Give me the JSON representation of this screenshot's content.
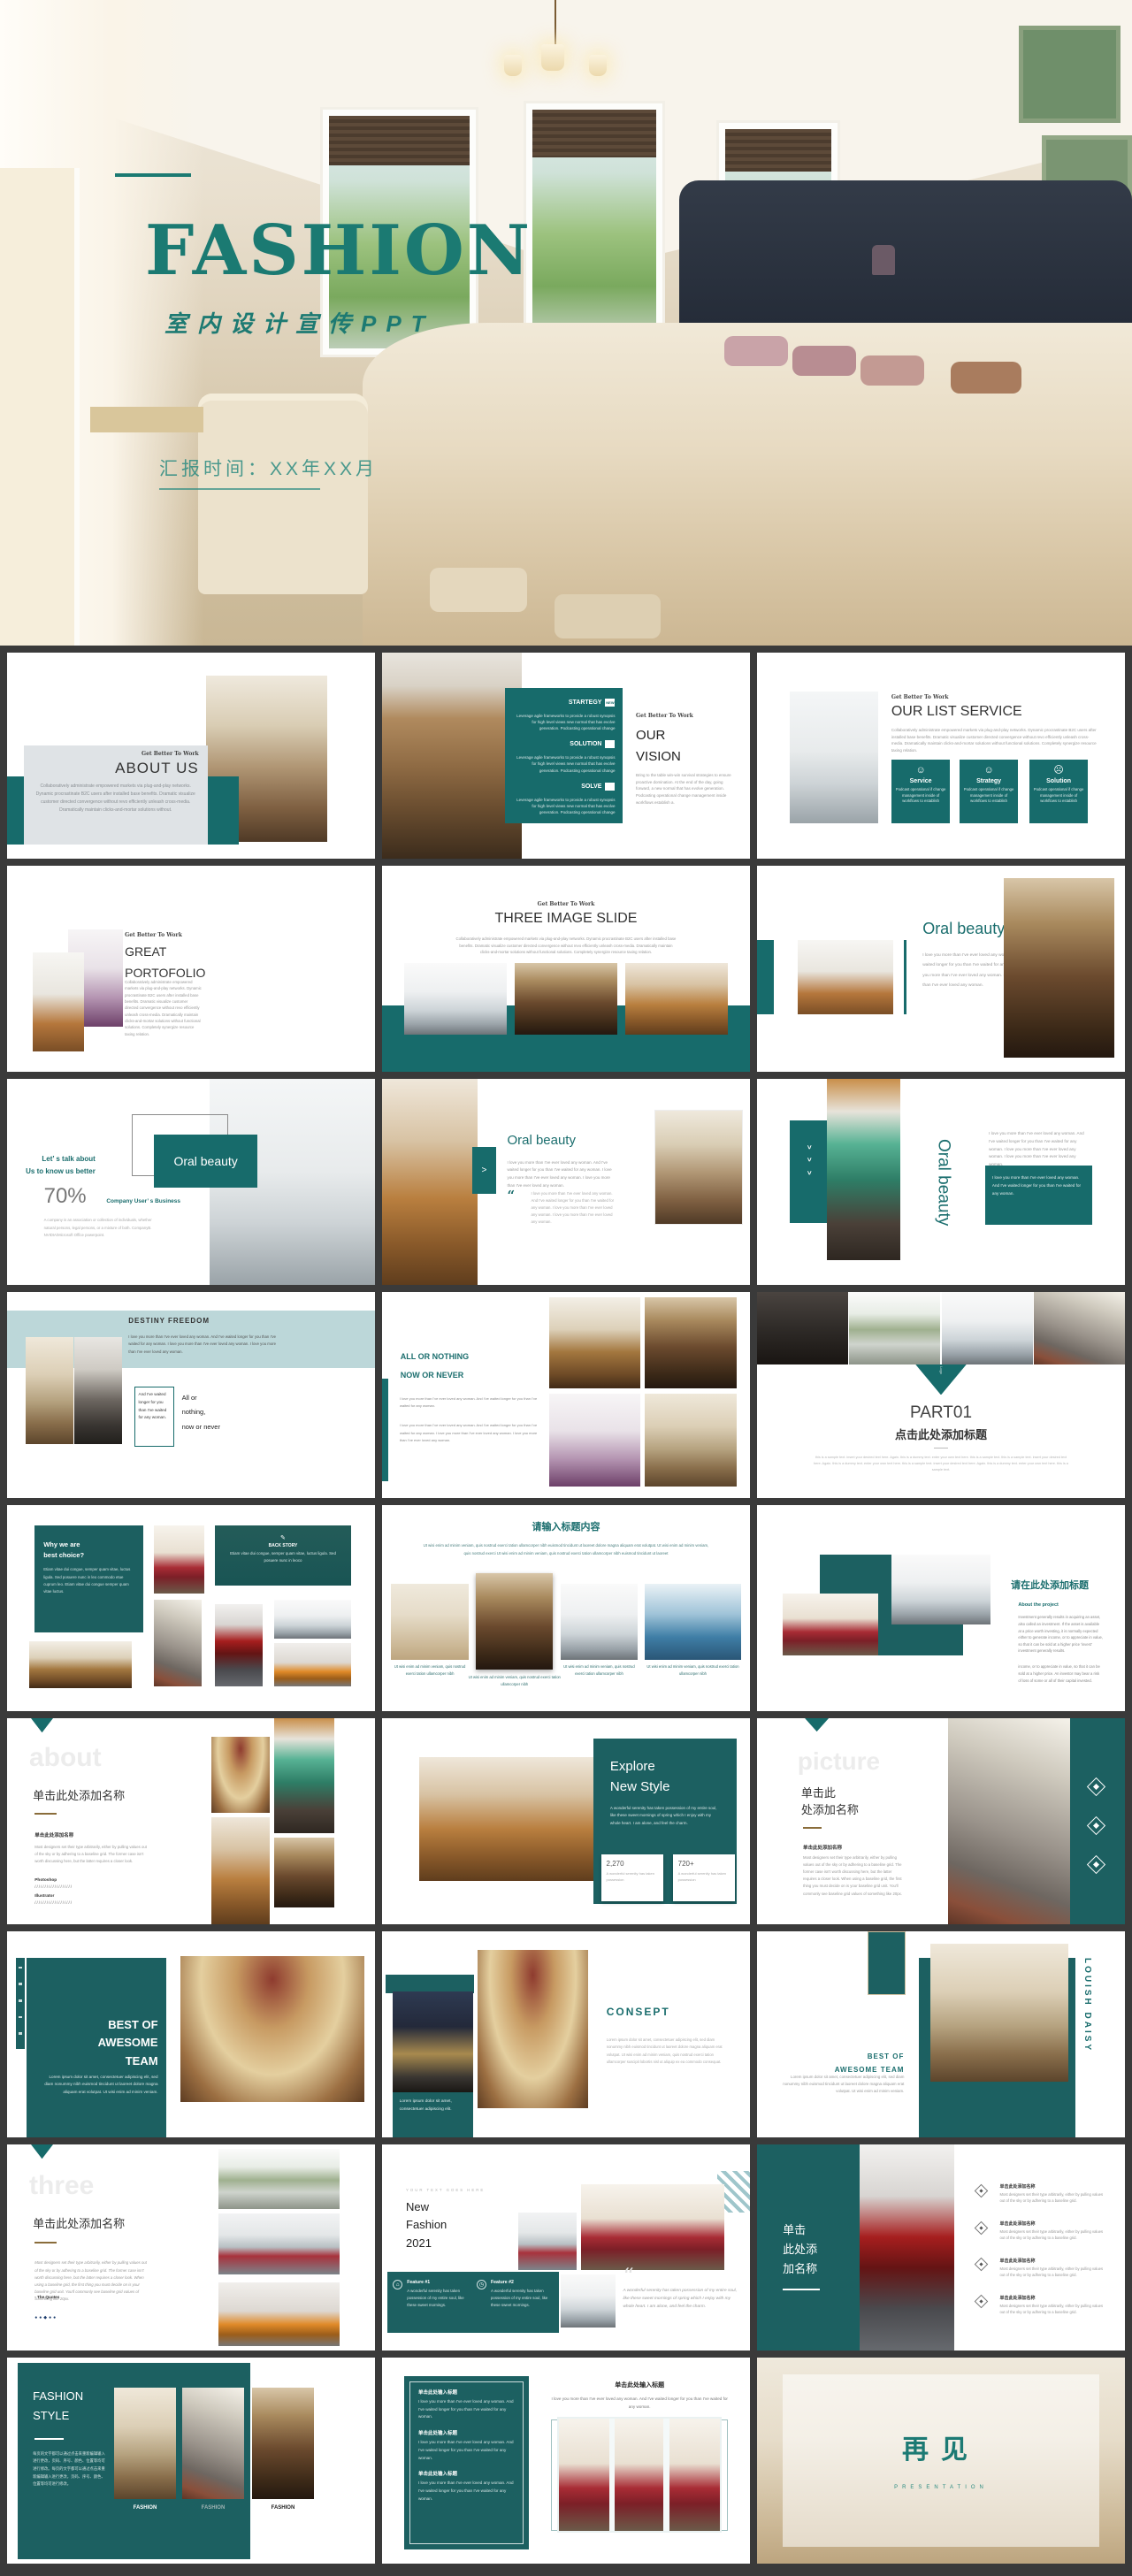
{
  "page": {
    "background": "#3a3a3a",
    "accent": "#176b6b"
  },
  "hero": {
    "title": "FASHION",
    "subtitle": "室内设计宣传PPT",
    "report_time": "汇报时间：XX年XX月"
  },
  "shared": {
    "kicker": "Get Better To Work",
    "collab_short": "Collaboratively administrate empowered markets via plug-and-play networks. Dynamic procrastinate B2C users after installed base benefits. Dramatic visualize customer directed convergence without revo efficiently unleash cross-media. Dramatically maintain clicks-and-mortar solutions without.",
    "collab": "Collaboratively administrate empowered markets via plug-and-play networks. Dynamic procrastinate B2C users after installed base benefits. Dramatic visualize customer directed convergence without revo efficiently unleash cross-media. Dramatically maintain clicks-and-mortar solutions without functional solutions. Completely synergize resource taxing relation.",
    "leverage": "Leverage agile frameworks to provide a robust synopsis for high level views new normal that has evolve generation. Podcasting operational change",
    "podcast": "Podcast operational if change management inside of workflows to establish",
    "love": "I love you more than I've ever loved any woman. And I've waited longer for you than I've waited for any woman.",
    "love_long": "I love you more than I've ever loved any woman. And I've waited longer for you than I've waited for any woman. I love you more than I've ever loved any woman. I love you more than I've ever loved any woman.",
    "designers": "Most designers set their type arbitrarily, either by pulling values out of the sky or by adhering to a baseline grid. The former case isn't worth discussing here, but the latter requires a closer look.",
    "designers_long": "Most designers set their type arbitrarily, either by pulling values out of the sky or by adhering to a baseline grid. The former case isn't worth discussing here, but the latter requires a closer look. When using a baseline grid, the first thing you must decide on is your baseline grid unit. You'll commonly see baseline grid values of something like 20px.",
    "designers_tiny": "Most designers set their type arbitrarily, either by pulling values out of the sky or by adhering to a baseline grid.",
    "lorem": "Lorem ipsum dolor sit amet, consectetuer adipiscing elit, sed diam nonummy nibh euismod tincidunt ut laoreet dolore magna aliquam erat volutpat. Ut wisi enim ad minim veniam.",
    "lorem_long": "Lorem ipsum dolor sit amet, consectetuer adipiscing elit, sed diam nonummy nibh euismod tincidunt ut laoreet dolore magna aliquam erat volutpat. Ut wisi enim ad minim veniam, quis nostrud exerci tation ullamcorper suscipit lobortis nisl ut aliquip ex ea commodo consequat.",
    "wonderful": "A wonderful serenity has taken possession of my entire soul, like these sweet mornings of spring which I enjoy with my whole heart. I am alone, and feel the charm.",
    "wonderful_short": "A wonderful serenity has taken possession of my entire soul, like these sweet mornings.",
    "serenity": "A wonderful serenity has taken possession",
    "utwisi": "Ut wisi enim ad minim veniam, quis nostrud exerci tation ullamcorper nibh euismod tincidunt ut laoreet dolore magna aliquam erat volutpat. Ut wisi enim ad minim veniam, quis nostrud exerci Ut wisi enim ad minim veniam, quis nostrud exerci tation ullamcorper nibh euismod tincidunt ut laoreet",
    "utwisi_tiny": "Ut wisi enim ad minim veniam, quis nostrud exerci tation ullamcorper nibh",
    "chevron": ">",
    "quote_mark": "“"
  },
  "slides": [
    {
      "title": "ABOUT US"
    },
    {
      "title": "OUR\nVISION",
      "items": [
        {
          "label": "STARTEGY",
          "badge": "NEW"
        },
        {
          "label": "SOLUTION",
          "badge": ""
        },
        {
          "label": "SOLVE",
          "badge": ""
        }
      ],
      "body": "Bring to the table win-win survival strategies to ensure proactive domination. At the end of the day, going forward, a new normal that has evolve generation. Podcasting operational change management inside workflows establish a."
    },
    {
      "title": "OUR LIST SERVICE",
      "cards": [
        {
          "icon": "☺",
          "title": "Service"
        },
        {
          "icon": "☺",
          "title": "Strategy"
        },
        {
          "icon": "☹",
          "title": "Solution"
        }
      ]
    },
    {
      "title": "GREAT\nPORTOFOLIO"
    },
    {
      "title": "THREE IMAGE SLIDE"
    },
    {
      "title": "Oral beauty"
    },
    {
      "heading": "Let’ s talk about\nUs to know us better",
      "percent": "70%",
      "label": "Company User’ s Business",
      "body": "A company is an association or collection of individuals, whether natural persons, legal persons, or a mixture of both. CompanyB. NVIDIA/Microsoft Office powerpoint.",
      "overlay": "Oral beauty"
    },
    {
      "title": "Oral beauty"
    },
    {
      "title": "Oral beauty"
    },
    {
      "title": "DESTINY  FREEDOM",
      "box": "And I've waited longer for you than I've waited for any woman.",
      "side": "All or\nnothing,\nnow or never"
    },
    {
      "title1": "ALL OR NOTHING",
      "title2": "NOW OR NEVER"
    },
    {
      "logo": "Logo",
      "part": "PART01",
      "title": "点击此处添加标题",
      "body": "this is a sample text. insert your desired text here. Again. this is a dummy text. enter your own text here. this is a sample text. this is a sample text. insert your desired text here. Again. this is a dummy text. enter your own text here. this is a sample text. insert your desired text here. Again. this is a dummy text. enter your own text here. this is a sample text."
    },
    {
      "title": "Why we are\nbest choice?",
      "body": "Etiam vitae dui congue, semper quam vitae, luctus ligula. Sed posuere nunc in leo commodo etue cuprum leo. Etiam vitae dui congue semper quam vitae luctus.",
      "back_story": "BACK STORY",
      "pencil": "✎",
      "back_body": "Etiam vitae dui congue, semper quam vitae, luctus ligula. Sed posuere nunc in leoco"
    },
    {
      "title": "请输入标题内容",
      "caption_mid": "市场前景分析"
    },
    {
      "title": "请在此处添加标题",
      "sub": "About the project",
      "body1": "Investment generally results in acquiring an asset, also called an investment. If the asset is available at a price worth investing, it is normally expected either to generate income, or to appreciate in value, so that it can be sold at a higher price 'invest' investment generally results.",
      "body2": "income, or to appreciate in value, so that it can be sold at a higher price. An investor may bear a risk of loss of some or all of their capital invested."
    },
    {
      "watermark": "about",
      "title": "单击此处添加名称",
      "sub": "单击此处添加名称",
      "skills": [
        {
          "name": "Photoshop",
          "bar": "///////////////////"
        },
        {
          "name": "Illustrator",
          "bar": "///////////////////"
        }
      ]
    },
    {
      "title": "Explore\nNew Style",
      "stats": [
        {
          "value": "2,270"
        },
        {
          "value": "720+"
        }
      ]
    },
    {
      "watermark": "picture",
      "title": "单击此\n处添加名称",
      "sub": "单击此处添加名称"
    },
    {
      "title": "BEST OF\nAWESOME\nTEAM"
    },
    {
      "title": "CONSEPT",
      "box": "Lorem ipsum dolor sit amet, consectetuer adipiscing elit."
    },
    {
      "vertical": "LOUISH DAISY",
      "title": "BEST OF\nAWESOME TEAM"
    },
    {
      "watermark": "three",
      "title": "单击此处添加名称",
      "quote": "- The Quotes",
      "dots": "●●◆●●"
    },
    {
      "kicker": "YOUR TEXT GOES HERE",
      "title": "New\nFashion\n2021",
      "features": [
        {
          "icon": "⌂",
          "name": "Feature #1"
        },
        {
          "icon": "◷",
          "name": "Feature #2"
        }
      ]
    },
    {
      "title": "单击\n此处添\n加名称",
      "items": [
        {
          "title": "单击此处添加名称"
        },
        {
          "title": "单击此处添加名称"
        },
        {
          "title": "单击此处添加名称"
        },
        {
          "title": "单击此处添加名称"
        }
      ]
    },
    {
      "title": "FASHION\nSTYLE",
      "body": "每页的文字都可以通过点击来重新编辑输入进行更改，页码、序号、颜色、位置等均可进行修改。每页的文字都可以通过点击来重新编辑输入进行更改，页码、序号、颜色、位置等均可进行修改。",
      "captions": [
        "FASHION",
        "FASHION",
        "FASHION"
      ]
    },
    {
      "box_title": "单击此处输入标题",
      "right_title": "单击此处输入标题"
    },
    {
      "title": "再见",
      "subtitle": "PRESENTATION"
    }
  ]
}
